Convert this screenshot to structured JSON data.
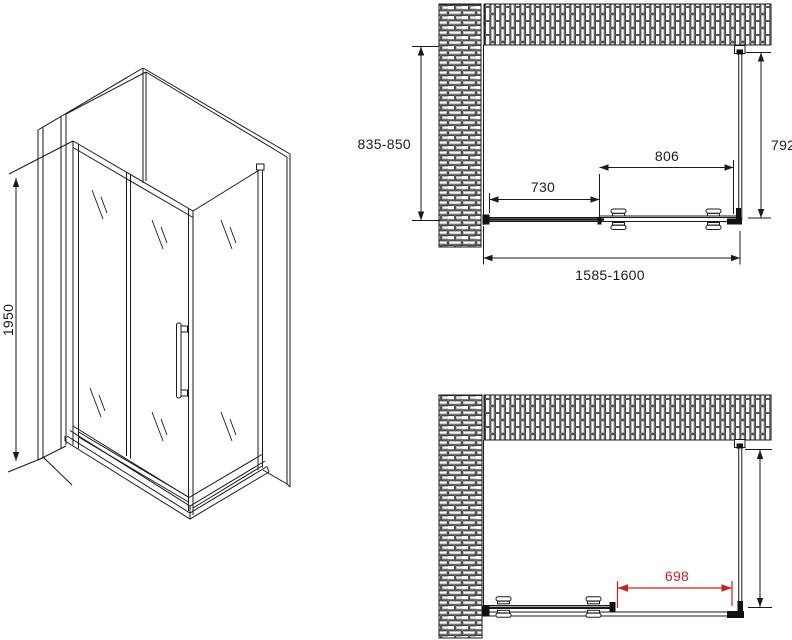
{
  "drawing": {
    "background": "#ffffff",
    "line_color": "#1a1a1a",
    "accent_color": "#cc2222",
    "views": {
      "isometric": {
        "dim_height": "1950"
      },
      "plan_closed": {
        "dim_wall_depth": "835-850",
        "dim_fixed_panel": "730",
        "dim_door_panel": "806",
        "dim_side_panel": "792",
        "dim_total_width": "1585-1600"
      },
      "plan_open": {
        "dim_opening": "698"
      }
    }
  }
}
